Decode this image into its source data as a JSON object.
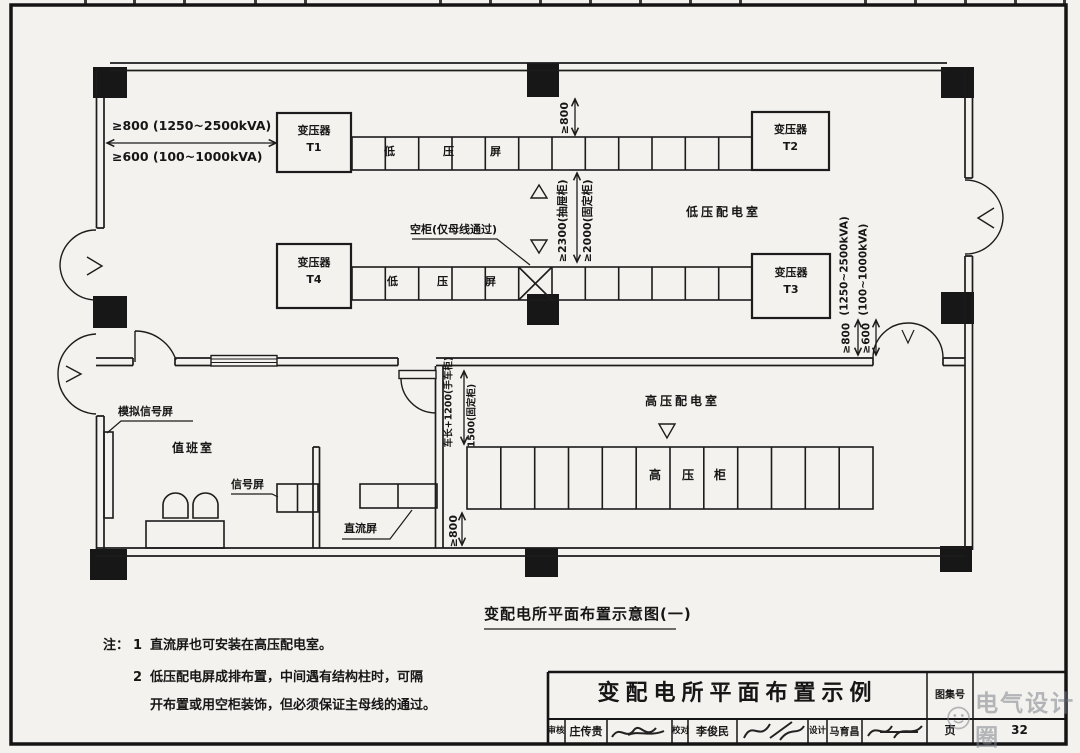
{
  "document": {
    "caption": "变配电所平面布置示意图(一)",
    "notes_label": "注：",
    "note1_num": "1",
    "note1_line1": "直流屏也可安装在高压配电室。",
    "note2_num": "2",
    "note2_line1": "低压配电屏成排布置，中间遇有结构柱时，可隔",
    "note2_line2": "开布置或用空柜装饰，但必须保证主母线的通过。"
  },
  "plan": {
    "room_labels": {
      "lv": "低压配电室",
      "hv": "高压配电室",
      "duty": "值班室"
    },
    "transformers": {
      "t1_name": "变压器",
      "t1_id": "T1",
      "t2_name": "变压器",
      "t2_id": "T2",
      "t3_name": "变压器",
      "t3_id": "T3",
      "t4_name": "变压器",
      "t4_id": "T4"
    },
    "lv_row1_chars": {
      "c1": "低",
      "c2": "压",
      "c3": "屏"
    },
    "lv_row2_chars": {
      "c1": "低",
      "c2": "压",
      "c3": "屏"
    },
    "hv_row_chars": {
      "c1": "高",
      "c2": "压",
      "c3": "柜"
    },
    "equipment_labels": {
      "mimic_panel": "模拟信号屏",
      "signal_panel": "信号屏",
      "dc_panel": "直流屏",
      "empty_cabinet": "空柜(仅母线通过)"
    },
    "dimensions": {
      "left_row1": "≥800 (1250~2500kVA)",
      "left_row2": "≥600 (100~1000kVA)",
      "top_mid": "≥800",
      "aisle_drawer": "≥2300(抽屉柜)",
      "aisle_fixed": "≥2000(固定柜)",
      "right_kva_1": "(1250~2500kVA)",
      "right_kva_2": "(100~1000kVA)",
      "right_d1": "≥800",
      "right_d2": "≥600",
      "hv_aisle_1": "车长+1200(手车柜)",
      "hv_aisle_2": "1500(固定柜)",
      "hv_d1": "≥800"
    }
  },
  "title_block": {
    "title": "变配电所平面布置示例",
    "atlas_no_label": "图集号",
    "page_label": "页",
    "page_value": "32",
    "review_label": "审核",
    "review_name": "庄传贵",
    "check_label": "校对",
    "check_name": "李俊民",
    "design_label": "设计",
    "design_name": "马育昌",
    "watermark": "电气设计圈"
  }
}
